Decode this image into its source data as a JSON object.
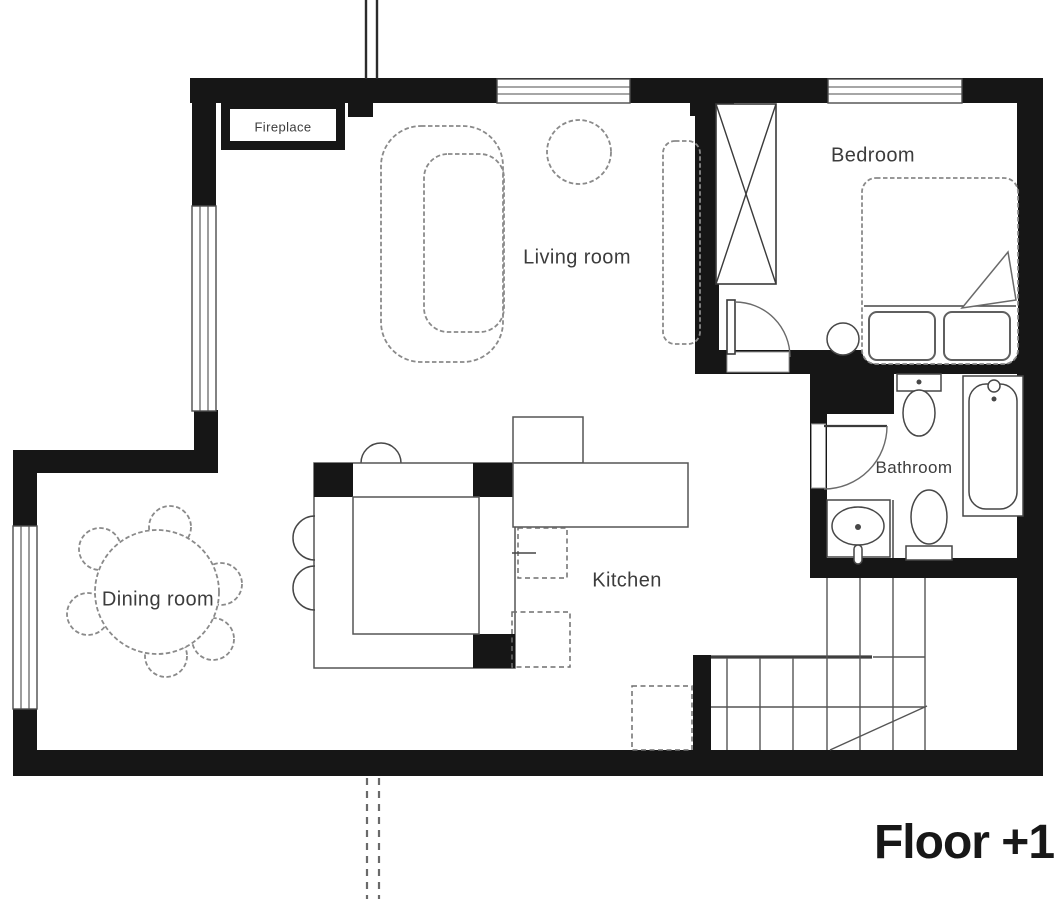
{
  "page": {
    "type": "floor-plan",
    "floor_label": "Floor +1"
  },
  "rooms": {
    "living_room": {
      "label": "Living room"
    },
    "bedroom": {
      "label": "Bedroom"
    },
    "bathroom": {
      "label": "Bathroom"
    },
    "kitchen": {
      "label": "Kitchen"
    },
    "dining_room": {
      "label": "Dining room"
    },
    "fireplace": {
      "label": "Fireplace"
    }
  },
  "furniture_icons": [
    "sofa-icon",
    "side-table-icon",
    "tv-console-icon",
    "wardrobe-icon",
    "bed-icon",
    "pillow-icon",
    "blanket-fold-icon",
    "nightstand-icon",
    "door-swing-icon",
    "toilet-icon",
    "bidet-icon",
    "bathtub-icon",
    "sink-icon",
    "kitchen-island-icon",
    "kitchen-counter-icon",
    "oven-icon",
    "dishwasher-icon",
    "bar-stool-icon",
    "dining-table-icon",
    "dining-chair-icon",
    "staircase-icon",
    "storage-box-icon",
    "window-icon",
    "chimney-pipe-icon",
    "drain-pipe-icon"
  ],
  "colors": {
    "wall": "#161616",
    "window_line": "#4d4d4d",
    "fixture_line": "#474747",
    "furniture_line": "#8a8a8a",
    "stair_line": "#555555",
    "text": "#3c3c3c",
    "floor_text": "#171717",
    "background": "#ffffff"
  }
}
